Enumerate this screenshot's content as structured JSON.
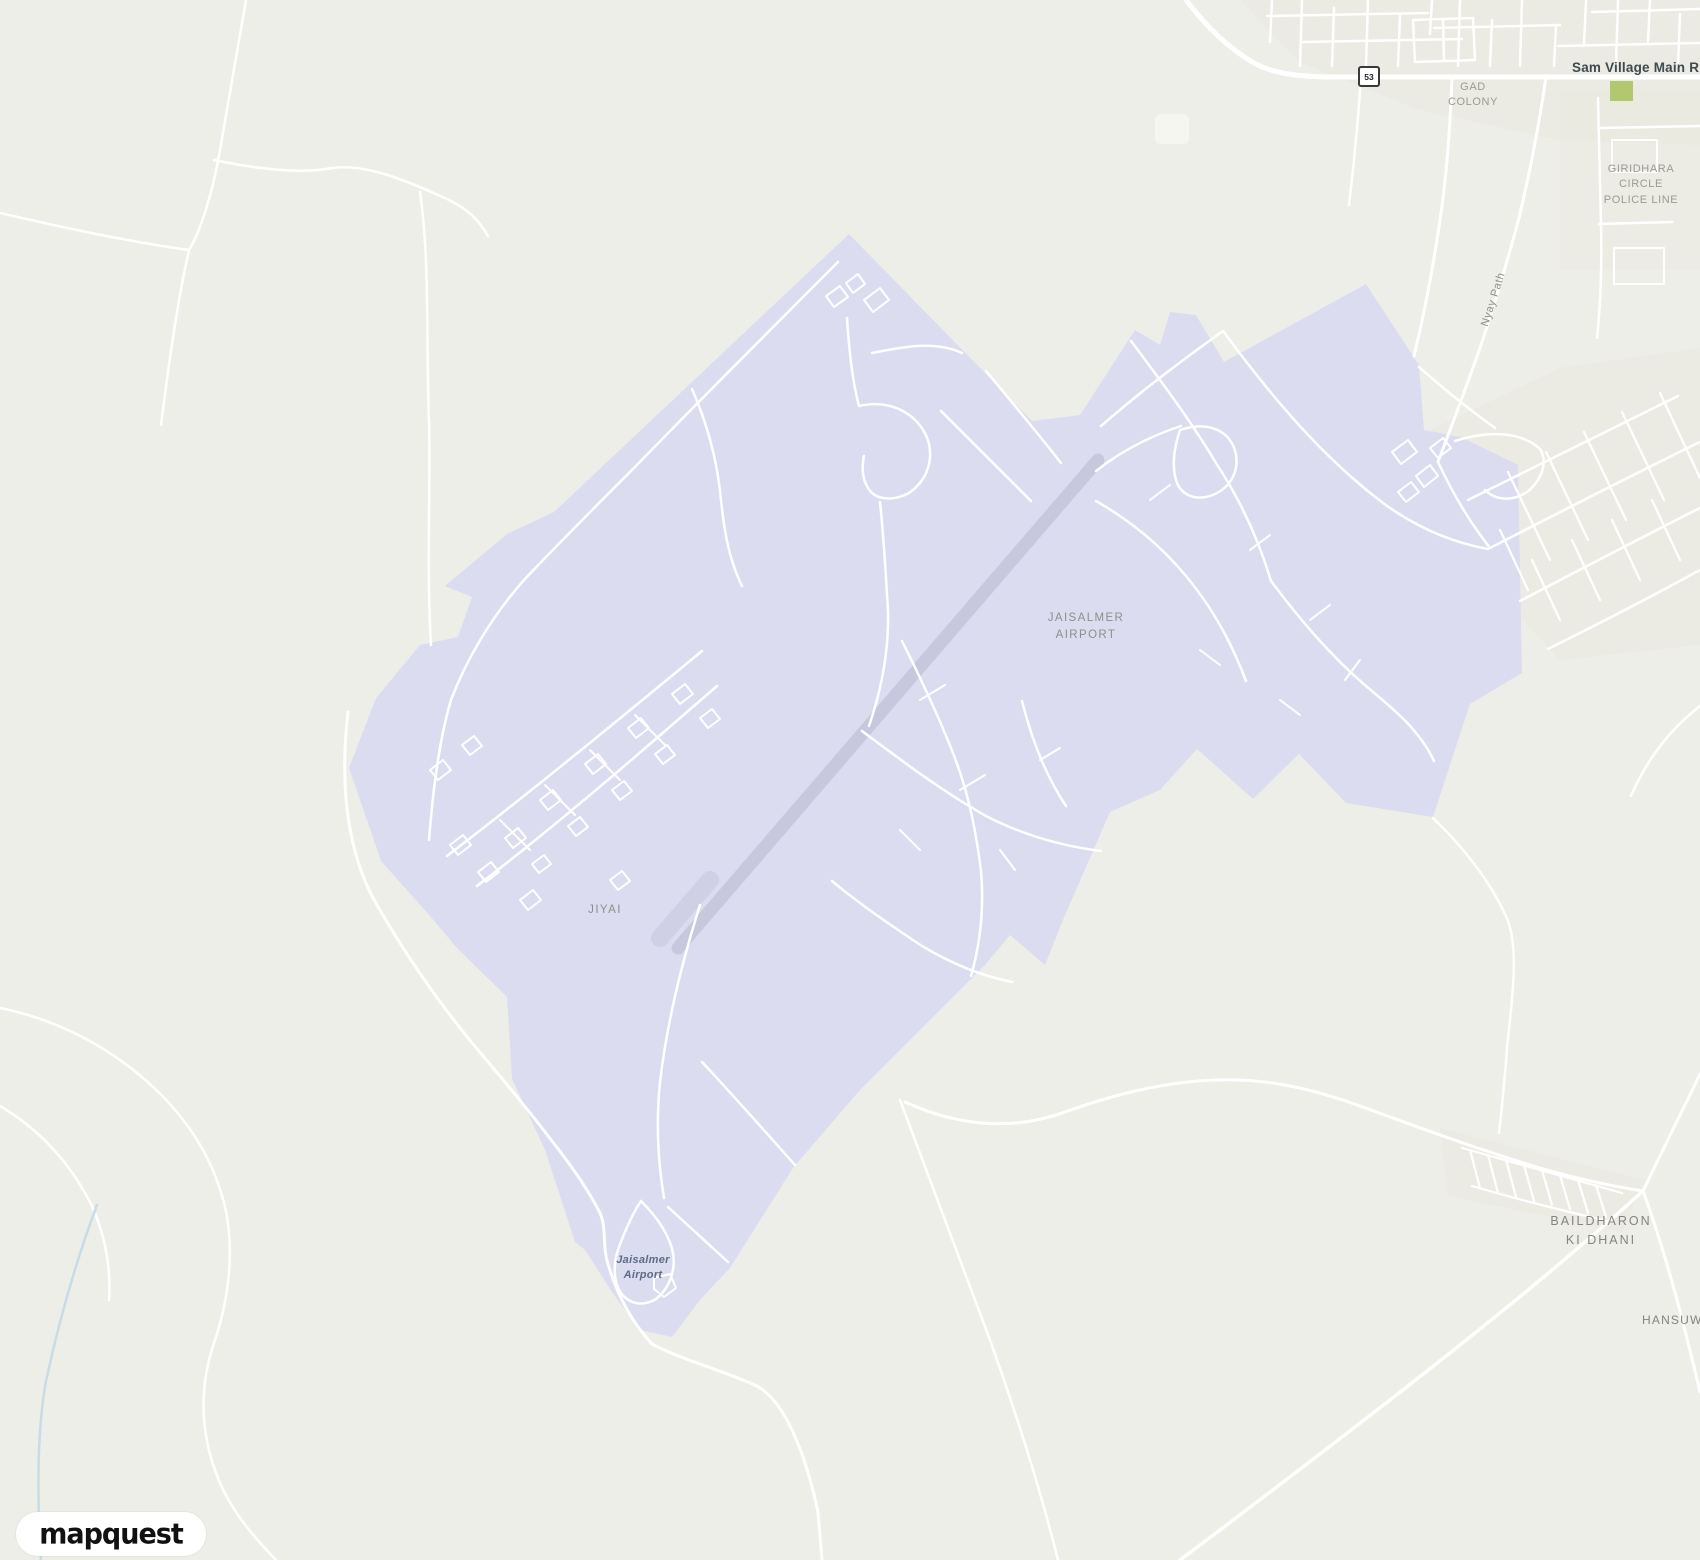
{
  "app": {
    "name": "MapQuest map view - Jaisalmer Airport"
  },
  "colors": {
    "land": "#eeeee8",
    "land_shade": "#e8e7dd",
    "airport_fill": "#dcdcf1",
    "runway": "#c7c7de",
    "road": "#ffffff",
    "water": "#c9dbe4",
    "park_green": "#b2c86f",
    "label_gray": "#8f8e86",
    "label_dark": "#3e4a50",
    "city_label": "#84847c",
    "poi_blue": "#5d6b85",
    "shield_border": "#3a3a3a"
  },
  "labels": {
    "main_road": "Sam Village Main R",
    "route_shield": "53",
    "gad_colony": [
      "GAD",
      "COLONY"
    ],
    "giridhara": [
      "GIRIDHARA",
      "CIRCLE",
      "POLICE LINE"
    ],
    "nyay_path": "Nyay Path",
    "airport_area": [
      "JAISALMER",
      "AIRPORT"
    ],
    "jiyai": "JIYAI",
    "airport_poi": [
      "Jaisalmer",
      "Airport"
    ],
    "baildharon": [
      "BAILDHARON",
      "KI DHANI"
    ],
    "hansuwa": "HANSUW"
  },
  "attribution": {
    "logo_text": "mapquest"
  }
}
